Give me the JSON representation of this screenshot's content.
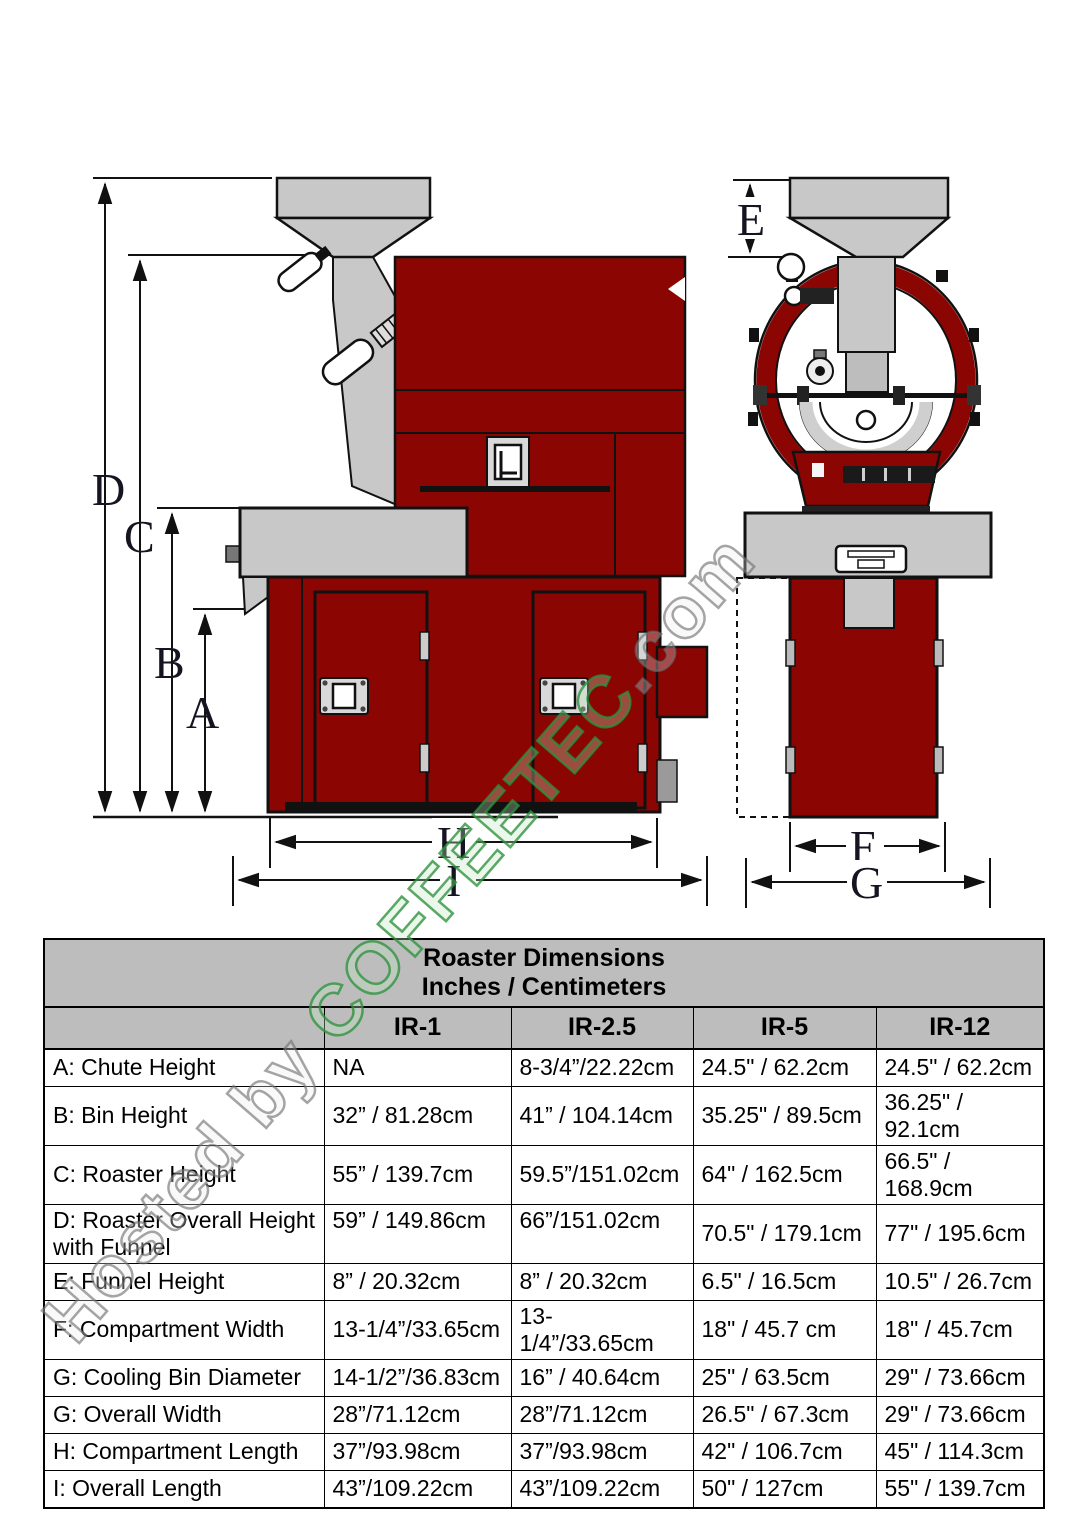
{
  "watermark": {
    "prefix": "Hosted by ",
    "brand": "COFFEETEC",
    "suffix": ".com",
    "brand_color": "#2d913c",
    "muted_color": "#6e6e6e"
  },
  "diagram": {
    "machine_color": "#8B0503",
    "metal_color": "#c8c8c8",
    "dim_labels": {
      "a": "A",
      "b": "B",
      "c": "C",
      "d": "D",
      "e": "E",
      "f": "F",
      "g": "G",
      "h": "H",
      "i": "I"
    }
  },
  "table": {
    "title_line1": "Roaster Dimensions",
    "title_line2": "Inches / Centimeters",
    "columns": [
      "IR-1",
      "IR-2.5",
      "IR-5",
      "IR-12"
    ],
    "rows": [
      {
        "label": "A: Chute Height",
        "values": [
          "NA",
          "8-3/4”/22.22cm",
          "24.5\" / 62.2cm",
          "24.5\" / 62.2cm"
        ]
      },
      {
        "label": "B: Bin Height",
        "values": [
          "32” / 81.28cm",
          "41” / 104.14cm",
          "35.25\" / 89.5cm",
          "36.25\" / 92.1cm"
        ]
      },
      {
        "label": "C: Roaster Height",
        "values": [
          "55” / 139.7cm",
          "59.5”/151.02cm",
          "64\" / 162.5cm",
          "66.5\" / 168.9cm"
        ]
      },
      {
        "label": "D: Roaster Overall Height with Funnel",
        "values": [
          "59” / 149.86cm",
          "66”/151.02cm",
          "70.5\" / 179.1cm",
          "77\" / 195.6cm"
        ]
      },
      {
        "label": "E: Funnel Height",
        "values": [
          "8” / 20.32cm",
          "8” / 20.32cm",
          "6.5\" / 16.5cm",
          "10.5\" / 26.7cm"
        ]
      },
      {
        "label": "F: Compartment Width",
        "values": [
          "13-1/4”/33.65cm",
          "13-1/4”/33.65cm",
          "18\" / 45.7 cm",
          "18\" / 45.7cm"
        ]
      },
      {
        "label": "G: Cooling Bin Diameter",
        "values": [
          "14-1/2”/36.83cm",
          "16” / 40.64cm",
          "25\" / 63.5cm",
          "29\" / 73.66cm"
        ]
      },
      {
        "label": "G: Overall Width",
        "values": [
          "28”/71.12cm",
          "28”/71.12cm",
          "26.5\" / 67.3cm",
          "29\" / 73.66cm"
        ]
      },
      {
        "label": "H: Compartment Length",
        "values": [
          "37”/93.98cm",
          "37”/93.98cm",
          "42\" / 106.7cm",
          "45\" / 114.3cm"
        ]
      },
      {
        "label": "I: Overall Length",
        "values": [
          "43”/109.22cm",
          "43”/109.22cm",
          "50\" / 127cm",
          "55\" / 139.7cm"
        ]
      }
    ]
  }
}
